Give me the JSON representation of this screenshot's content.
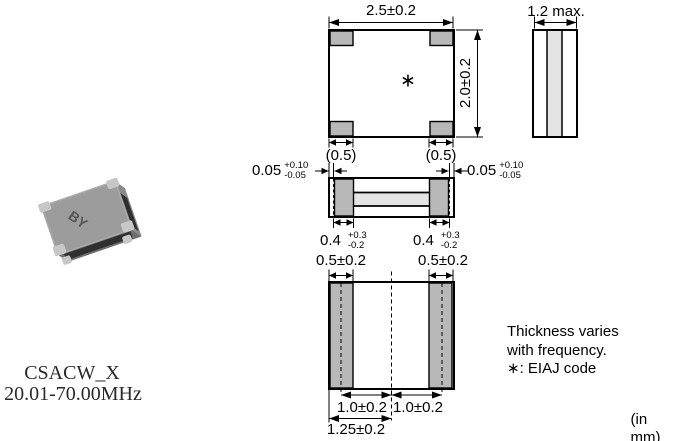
{
  "page": {
    "units_note": "(in mm)"
  },
  "product": {
    "series": "CSACW_X",
    "frequency_range": "20.01-70.00MHz",
    "marking": "BY"
  },
  "notes": {
    "line1": "Thickness varies",
    "line2": "with frequency.",
    "line3": "∗: EIAJ code"
  },
  "views": {
    "top": {
      "width": "2.5±0.2",
      "height": "2.0±0.2",
      "corner_pad_left": "(0.5)",
      "corner_pad_right": "(0.5)",
      "eiaj_code_mark": "∗"
    },
    "side": {
      "thickness": "1.2 max."
    },
    "front": {
      "edge_margin_left": {
        "value": "0.05",
        "tol_plus": "+0.10",
        "tol_minus": "-0.05"
      },
      "edge_margin_right": {
        "value": "0.05",
        "tol_plus": "+0.10",
        "tol_minus": "-0.05"
      },
      "terminal_left": {
        "value": "0.4",
        "tol_plus": "+0.3",
        "tol_minus": "-0.2"
      },
      "terminal_right": {
        "value": "0.4",
        "tol_plus": "+0.3",
        "tol_minus": "-0.2"
      }
    },
    "bottom": {
      "land_width_left": "0.5±0.2",
      "land_width_right": "0.5±0.2",
      "pitch_left": "1.0±0.2",
      "pitch_right": "1.0±0.2",
      "center_offset": "1.25±0.2"
    }
  },
  "colors": {
    "line": "#000000",
    "terminal_gray": "#b8b8b8",
    "ceramic_light": "#e4e4e4",
    "photo_body": "#9c9c9c"
  }
}
